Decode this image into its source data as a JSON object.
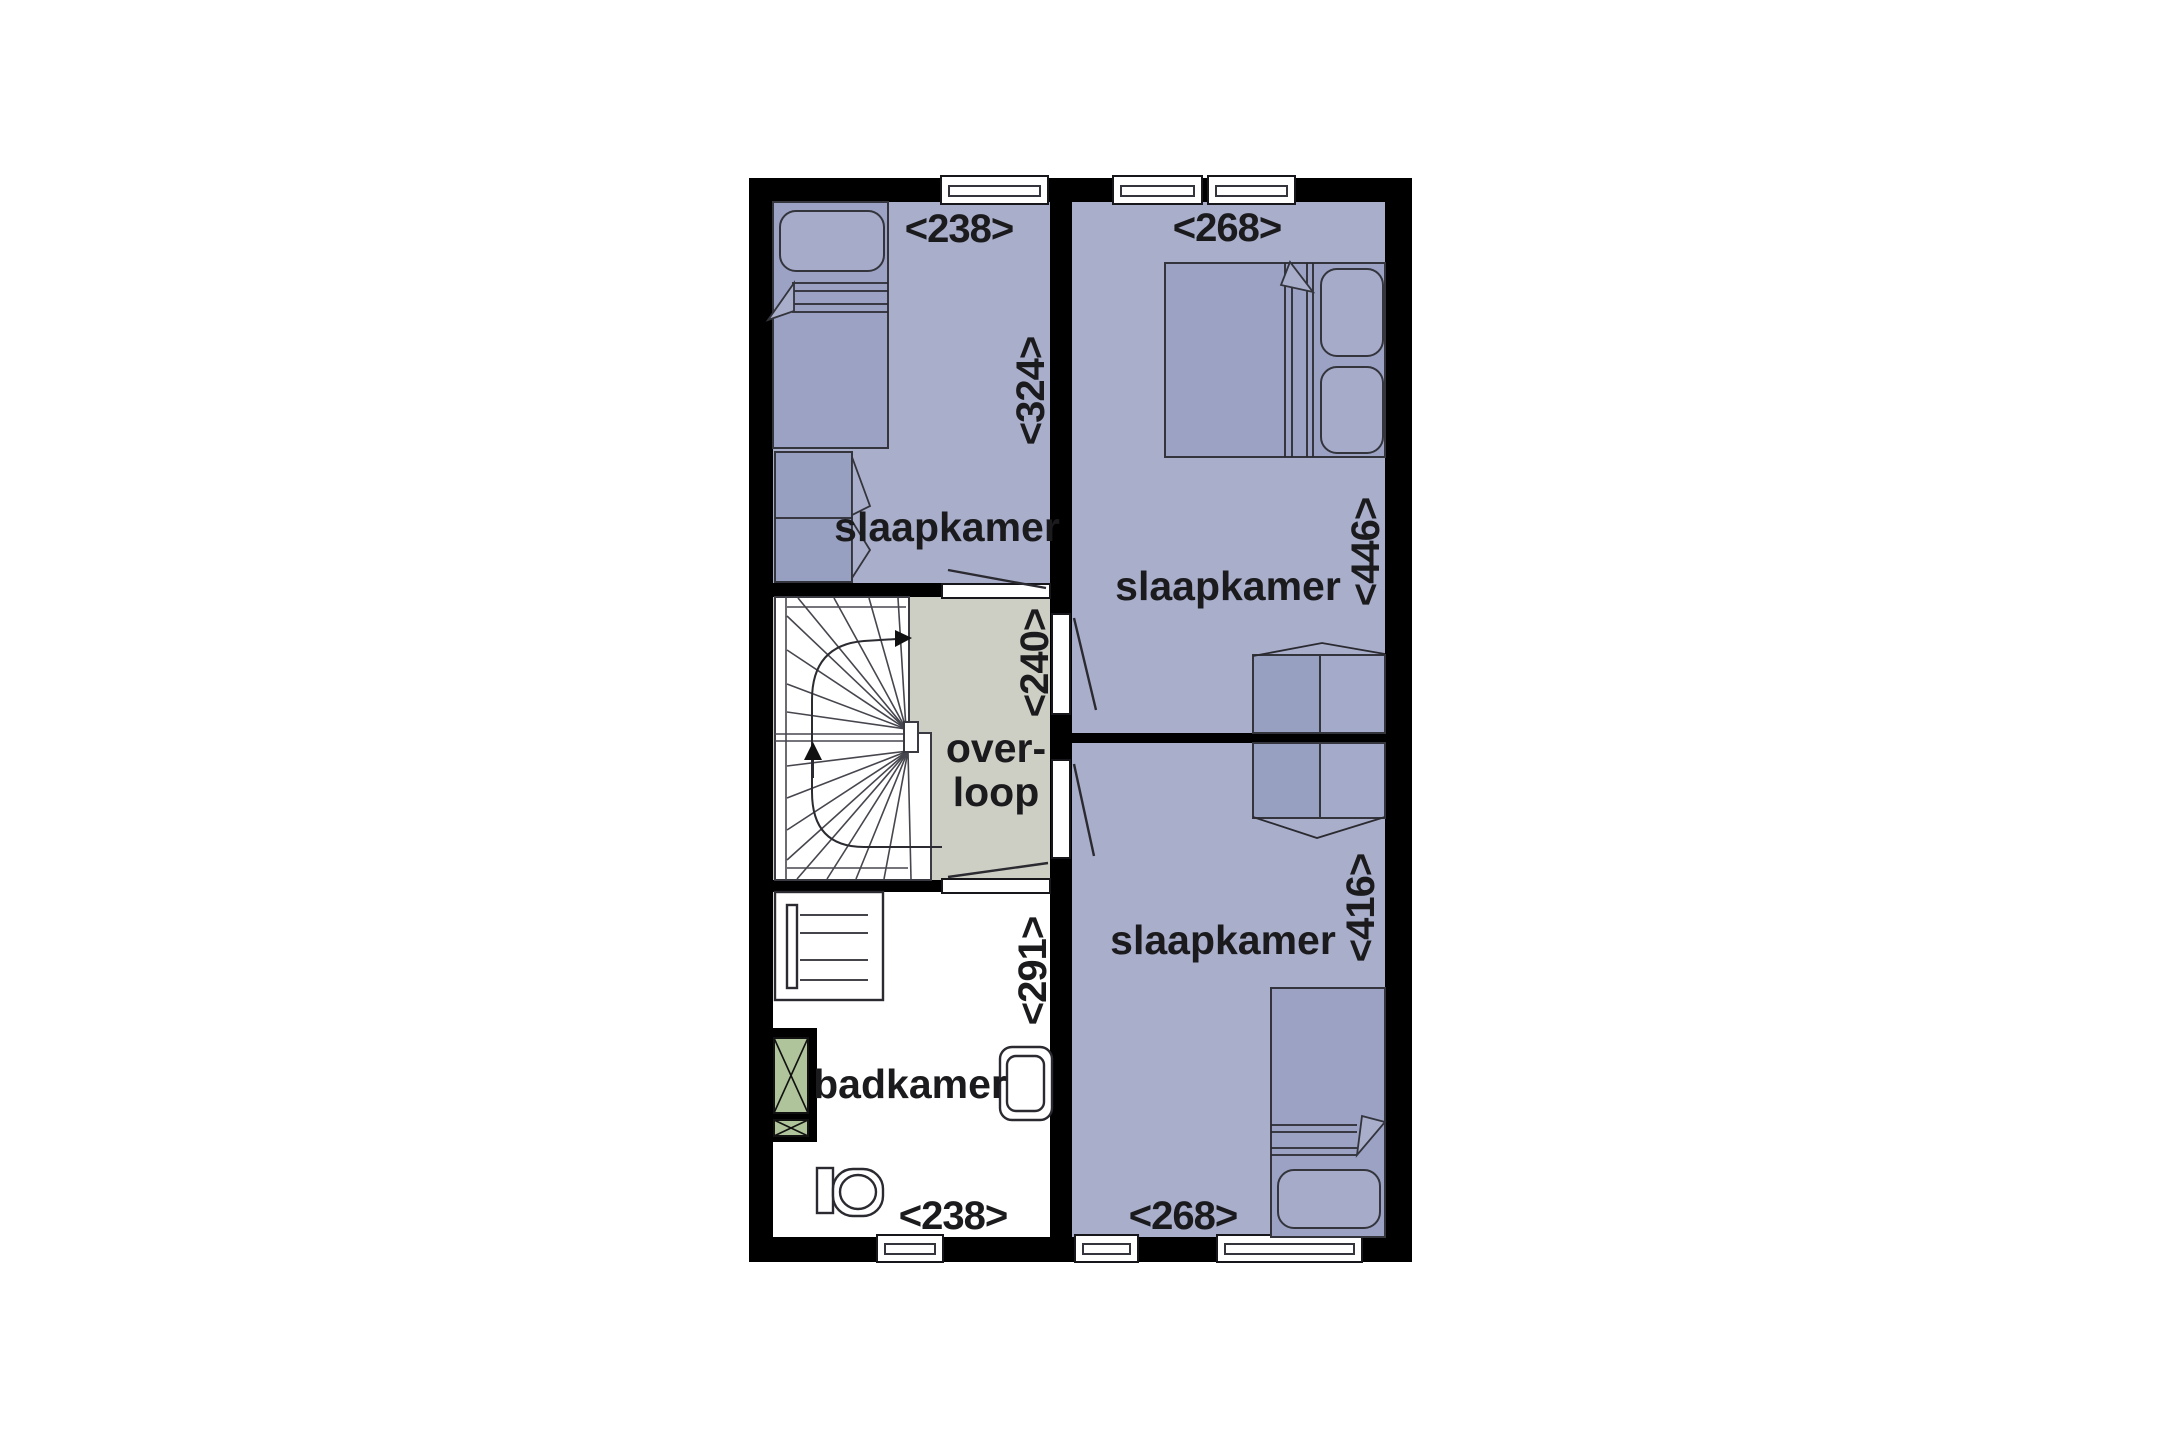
{
  "plan": {
    "room_labels": {
      "bedroom_top_left": "slaapkamer",
      "bedroom_top_right": "slaapkamer",
      "bedroom_bottom_right": "slaapkamer",
      "bathroom": "badkamer",
      "landing_line1": "over-",
      "landing_line2": "loop"
    },
    "dimension_labels": {
      "bedroom_top_left_width": "<238>",
      "bedroom_top_left_depth": "<324>",
      "bedroom_top_right_width": "<268>",
      "bedroom_top_right_depth": "<446>",
      "landing_depth": "<240>",
      "bathroom_depth": "<291>",
      "bathroom_width": "<238>",
      "bedroom_bottom_right_width": "<268>",
      "bedroom_bottom_right_depth": "<416>"
    },
    "colors": {
      "wall": "#000000",
      "room_fill": "#a9aecb",
      "furniture_fill": "#9ba2c4",
      "furniture_dark": "#98a0c2",
      "furniture_light": "#a4aac9",
      "pillow_fill": "#a6abc9",
      "landing_fill": "#cdcfc5",
      "cabinet_green": "#afc49a",
      "line": "#33343c",
      "text": "#1b1b1e"
    }
  }
}
